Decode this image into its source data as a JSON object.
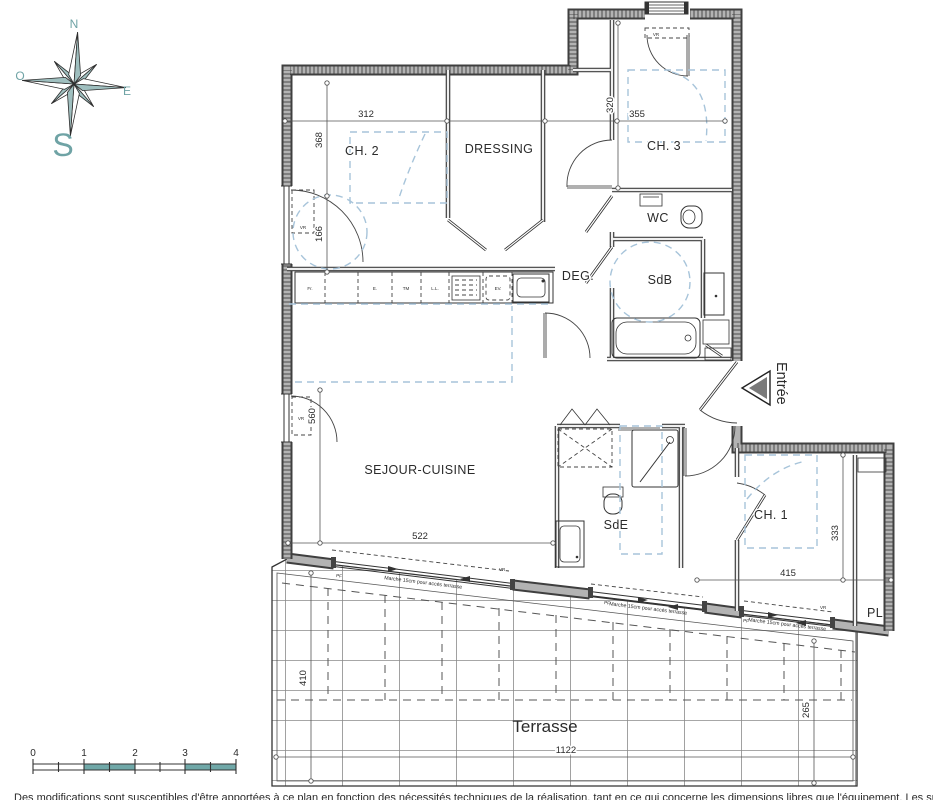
{
  "compass": {
    "n": "N",
    "o": "O",
    "e": "E",
    "s": "S"
  },
  "rooms": {
    "ch2": "CH. 2",
    "dressing": "DRESSING",
    "ch3": "CH. 3",
    "wc": "WC",
    "deg": "DEG.",
    "sdb": "SdB",
    "sejour": "SEJOUR-CUISINE",
    "sde": "SdE",
    "ch1": "CH. 1",
    "pl": "PL",
    "terrasse": "Terrasse"
  },
  "dims": {
    "d312": "312",
    "d355": "355",
    "d320": "320",
    "d368": "368",
    "d166": "166",
    "d560": "560",
    "d522": "522",
    "d415": "415",
    "d333": "333",
    "d1122": "1122",
    "d410": "410",
    "d265": "265"
  },
  "kitchen": {
    "fr": "Fr.",
    "e": "E.",
    "tm": "TM",
    "ll": "L.L.",
    "ev": "EV."
  },
  "labels": {
    "entree": "Entrée",
    "vr": "VR",
    "pf": "PF",
    "marche": "Marche 15cm pour accès terrasse"
  },
  "scalebar": {
    "t0": "0",
    "t1": "1",
    "t2": "2",
    "t3": "3",
    "t4": "4"
  },
  "disclaimer": "Des modifications sont susceptibles d'être apportées à ce plan en fonction des nécessités techniques de la réalisation, tant en ce qui concerne les dimensions libres que l'équipement. Les surfaces et hauteurs sous faux plafond indiqué",
  "colors": {
    "teal": "#6fa3a5",
    "wall_dark": "#3f3f3f",
    "wall_light": "#b3b3b3",
    "dash_blue": "#a7c4da",
    "disclaimer_text": "#4c9293"
  }
}
